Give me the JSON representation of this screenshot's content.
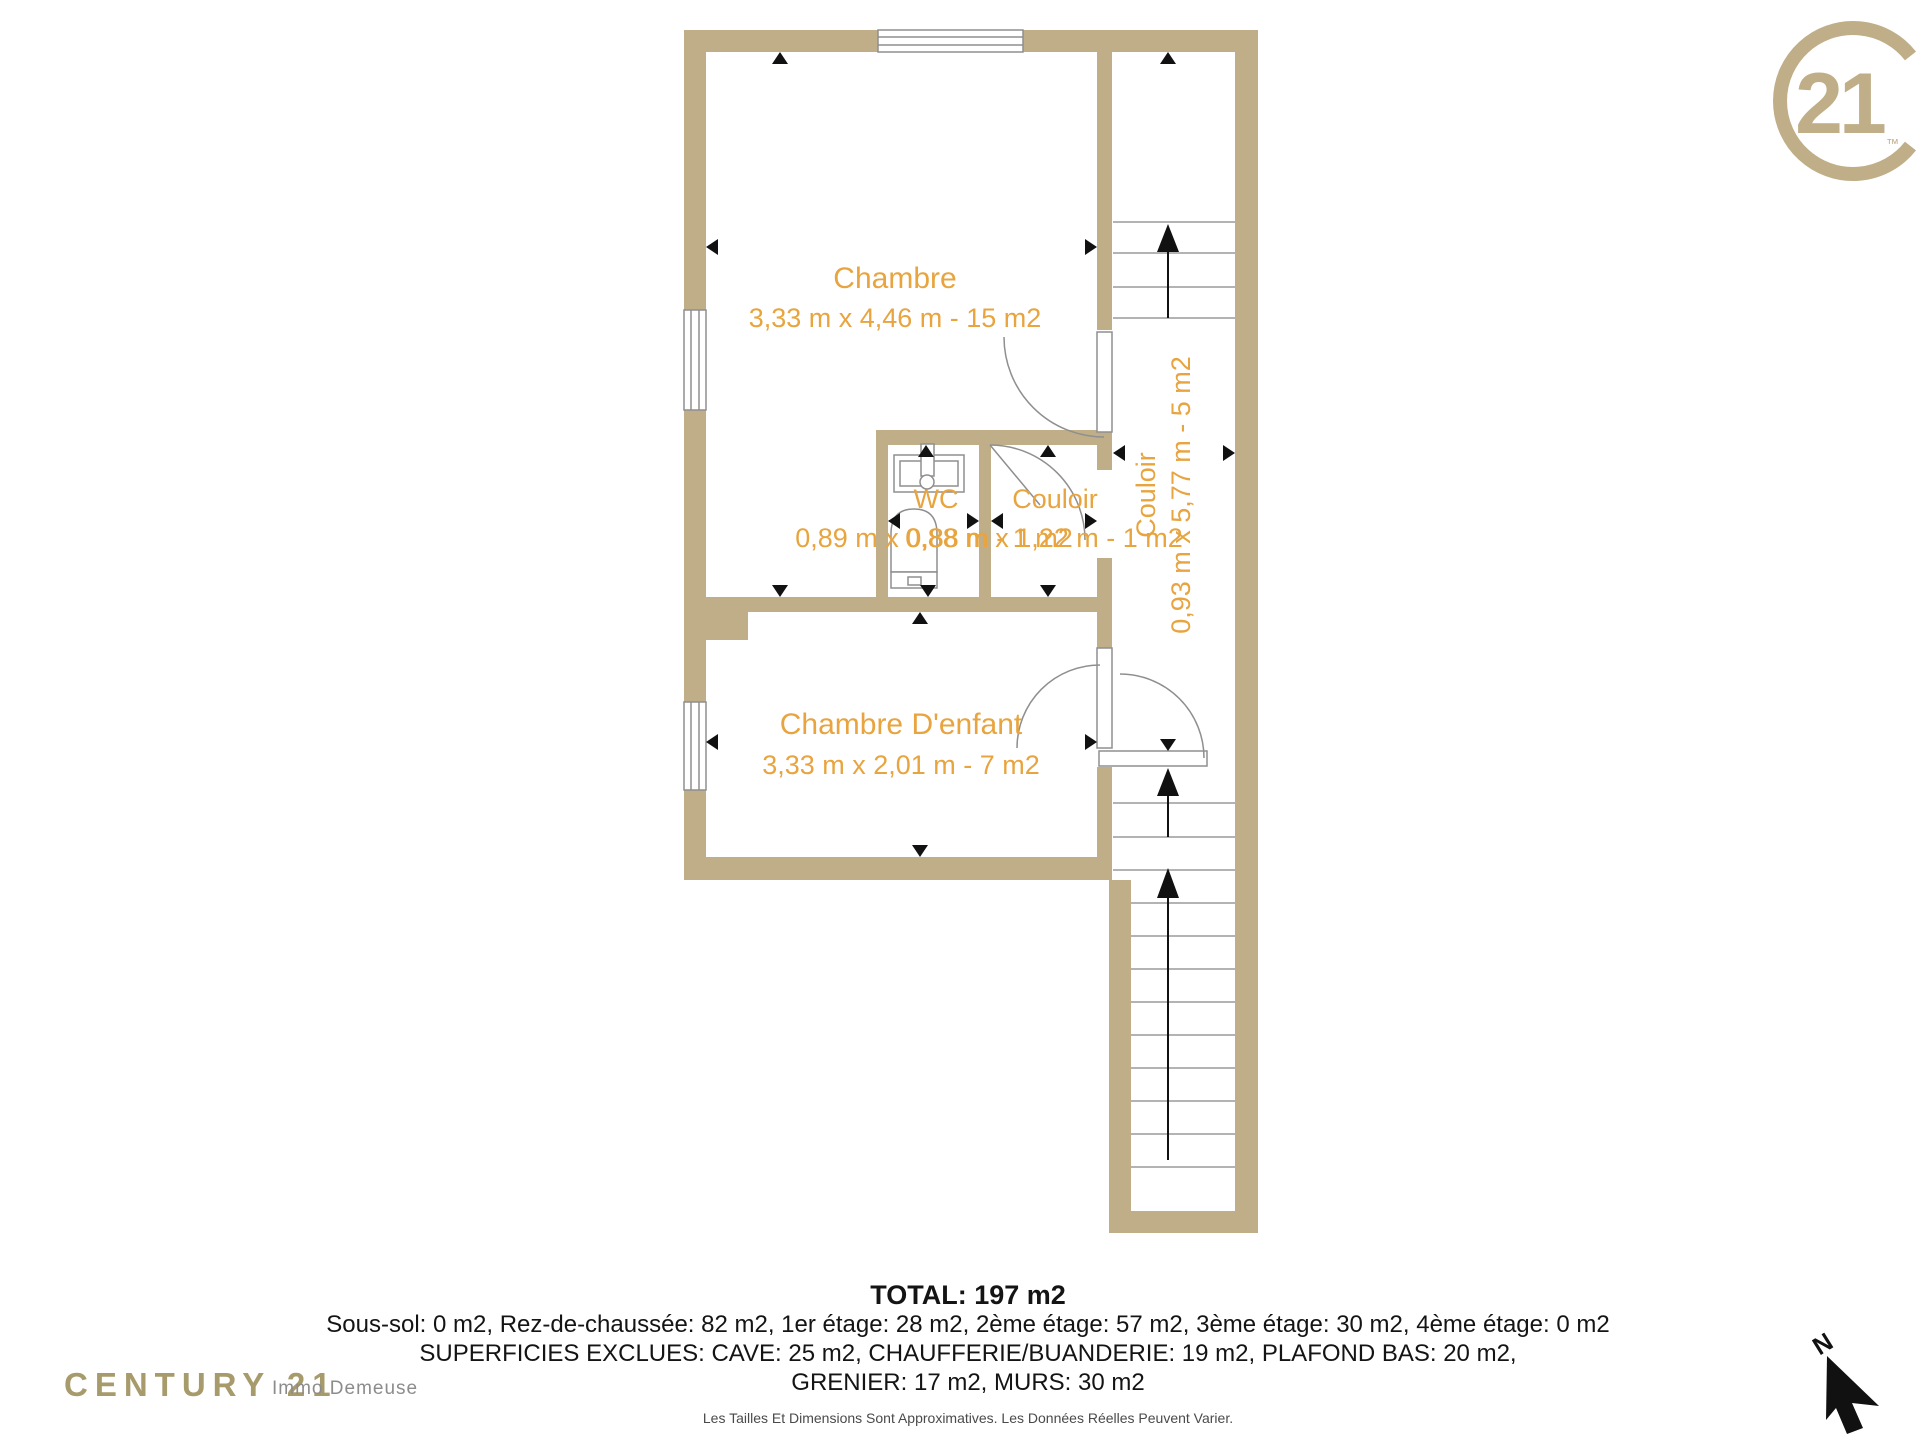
{
  "plan": {
    "rooms": [
      {
        "name": "Chambre",
        "dims": "3,33 m x 4,46 m - 15 m2"
      },
      {
        "name": "WC",
        "dims": "0,89 m x 0,88 m - 1 m2"
      },
      {
        "name": "Couloir",
        "dims": "0,88 m x 1,22 m - 1 m2"
      },
      {
        "name": "Couloir",
        "dims": "0,93 m x 5,77 m - 5 m2"
      },
      {
        "name": "Chambre D'enfant",
        "dims": "3,33 m x 2,01 m - 7 m2"
      }
    ]
  },
  "summary": {
    "total": "TOTAL: 197 m2",
    "line1": "Sous-sol: 0 m2, Rez-de-chaussée: 82 m2, 1er étage: 28 m2, 2ème étage: 57 m2, 3ème étage: 30 m2, 4ème étage: 0 m2",
    "line2": "SUPERFICIES EXCLUES: CAVE: 25 m2, CHAUFFERIE/BUANDERIE: 19 m2, PLAFOND BAS: 20 m2,",
    "line3": "GRENIER: 17 m2, MURS: 30 m2",
    "disclaimer": "Les Tailles Et Dimensions Sont Approximatives. Les Données Réelles Peuvent Varier."
  },
  "branding": {
    "seal_number": "21",
    "seal_tm": "™",
    "footer_brand": "CENTURY 21",
    "footer_agency": "Immo Demeuse"
  },
  "compass": {
    "north_label": "N"
  },
  "colors": {
    "wall": "#BFAE87",
    "label_orange": "#E8A43E",
    "plan_line_gray": "#8F8F8F",
    "brand_gold": "#BFAE87",
    "footer_gold": "#A79B6B",
    "footer_gray": "#8C8C8C",
    "text_black": "#141414"
  }
}
